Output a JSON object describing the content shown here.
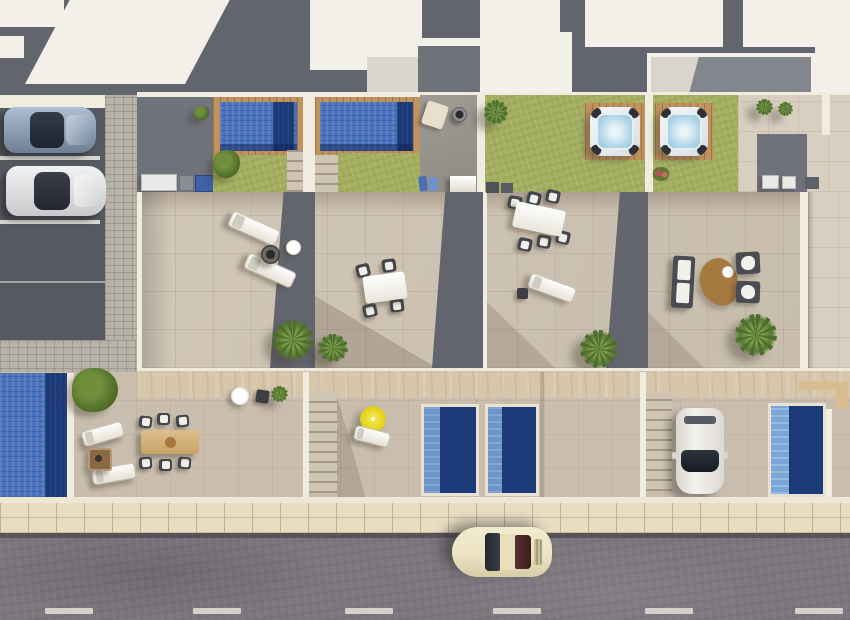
{
  "scene": {
    "type": "aerial-architectural-render",
    "description": "Top-down 3D render of a row of four modern townhouses with rooftop pools, hot tubs, furnished roof terraces, ground-floor patios with private pools, a parking bay with two cars, a driveway with a parked car, and a street with a passing classic car.",
    "units": [
      "unit-1",
      "unit-2",
      "unit-3",
      "unit-4"
    ],
    "amenities": [
      "rooftop-pool-1",
      "rooftop-pool-2",
      "hot-tub-1",
      "hot-tub-2",
      "roof-terraces",
      "ground-pools",
      "lawns"
    ],
    "furniture": [
      "sun-loungers",
      "dining-table-4-chairs",
      "dining-table-6-chairs",
      "outdoor-sofa-set",
      "kidney-rug",
      "fire-pit",
      "yellow-parasol",
      "wooden-dining-set"
    ],
    "vehicles": [
      {
        "name": "parked-hatchback",
        "color": "#93a7c0",
        "location": "parking-bay"
      },
      {
        "name": "parked-sedan",
        "color": "#ebebec",
        "location": "parking-bay"
      },
      {
        "name": "driveway-car",
        "color": "#eceae6",
        "location": "unit-4-driveway"
      },
      {
        "name": "street-car",
        "color": "#ebe3c2",
        "location": "road"
      }
    ]
  },
  "palette": {
    "roof-gray": "#63656e",
    "roof-gray2": "#70727b",
    "roof-white": "#f3f0e9",
    "wall": "#f1ece0",
    "parking": "#565960",
    "cobble": "#b7b2a8",
    "terrace": "#cfc4b3",
    "terrace-light": "#d9cfc0",
    "lawn": "#a4ae60",
    "wood": "#bf925e",
    "wood-light": "#d8bd92",
    "pool-light": "#4a72bd",
    "pool-dark": "#1d3a78",
    "pool-step": "#7aa6d8",
    "hottub-water": "#b5d8e8",
    "courtyard": "#9b968f",
    "walkway": "#d5c6ac",
    "patio": "#c9beae",
    "sidewalk": "#e8ddc3",
    "road": "#7b767c",
    "dash": "#dcd8d0",
    "chair": "#43454c",
    "parasol": "#e3d31d",
    "rug-brown": "#a5793f",
    "car-cream": "#ebe3c2"
  },
  "road": {
    "dashes_x": [
      45,
      193,
      345,
      493,
      645,
      795
    ],
    "dash_width": 48
  },
  "parking": {
    "line_ys": [
      48,
      112
    ]
  }
}
